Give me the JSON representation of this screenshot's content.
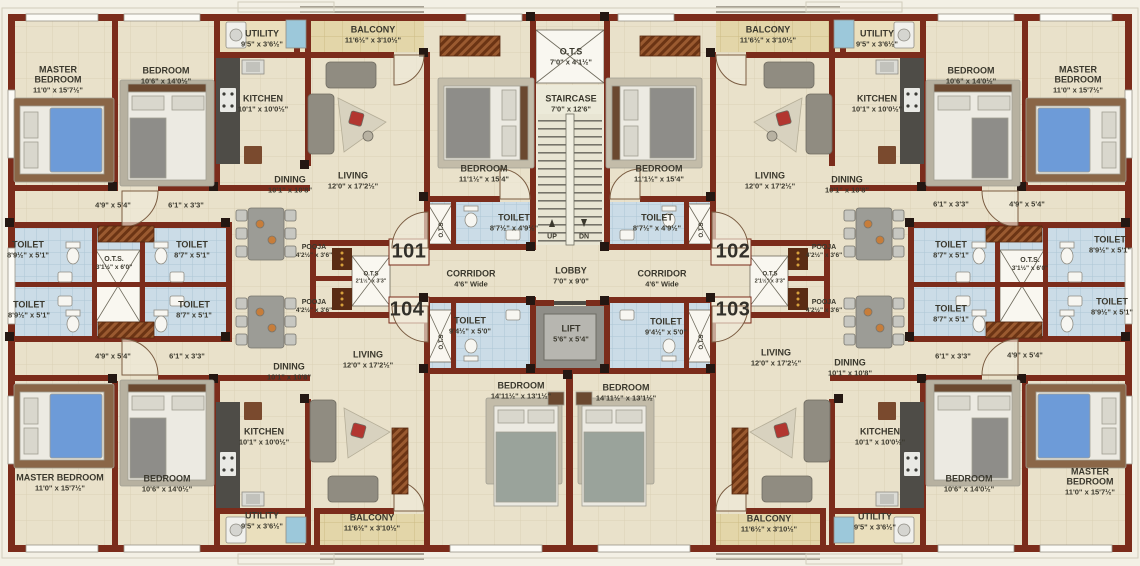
{
  "plan": {
    "units": {
      "tl": "101",
      "tr": "102",
      "br": "103",
      "bl": "104"
    },
    "rooms": {
      "master_bedroom": {
        "name": "MASTER BEDROOM",
        "dims": "11'0\" x 15'7½\""
      },
      "bedroom_a": {
        "name": "BEDROOM",
        "dims": "10'6\" x 14'0½\""
      },
      "bedroom_b": {
        "name": "BEDROOM",
        "dims": "11'1½\" x 15'4\""
      },
      "bedroom_c": {
        "name": "BEDROOM",
        "dims": "14'11½\" x 13'1½\""
      },
      "utility": {
        "name": "UTILITY",
        "dims": "9'5\" x 3'6½\""
      },
      "kitchen": {
        "name": "KITCHEN",
        "dims": "10'1\" x 10'0½\""
      },
      "dining": {
        "name": "DINING",
        "dims": "10'1\" x 10'8\""
      },
      "living": {
        "name": "LIVING",
        "dims": "12'0\" x 17'2½\""
      },
      "balcony": {
        "name": "BALCONY",
        "dims": "11'6½\" x 3'10½\""
      },
      "pooja": {
        "name": "POOJA",
        "dims": "4'2½\" x 3'6\""
      },
      "toilet_a": {
        "name": "TOILET",
        "dims": "8'7½\" x 4'9½\""
      },
      "toilet_b": {
        "name": "TOILET",
        "dims": "9'4½\" x 5'0\""
      },
      "toilet_c": {
        "name": "TOILET",
        "dims": "8'9½\" x 5'1\""
      },
      "toilet_d": {
        "name": "TOILET",
        "dims": "8'7\" x 5'1\""
      },
      "staircase": {
        "name": "STAIRCASE",
        "dims": "7'0\" x 12'6\""
      },
      "ots_top": {
        "name": "O.T.S",
        "dims": "7'0\" x 4'1½\""
      },
      "ots_side": {
        "name": "O.T.S.",
        "dims": "3'1½\" x 6'0\""
      },
      "ots_mid": {
        "name": "O.T.S",
        "dims": "2'1½\" x 3'3\""
      },
      "ots_shaft": {
        "name": "O.T.S"
      },
      "lobby": {
        "name": "LOBBY",
        "dims": "7'0\" x 9'0\""
      },
      "corridor": {
        "name": "CORRIDOR",
        "dims": "4'6\" Wide"
      },
      "lift": {
        "name": "LIFT",
        "dims": "5'6\" x 5'4\""
      }
    },
    "passages": {
      "a": "4'9\" x 5'4\"",
      "b": "6'1\" x 3'3\""
    },
    "stairs": {
      "up": "UP",
      "dn": "DN"
    },
    "colors": {
      "wall": "#7b2c1b",
      "floor": "#e9e1ca",
      "toilet_floor": "#cadbe6",
      "balcony_floor": "#e4d7ab"
    }
  }
}
